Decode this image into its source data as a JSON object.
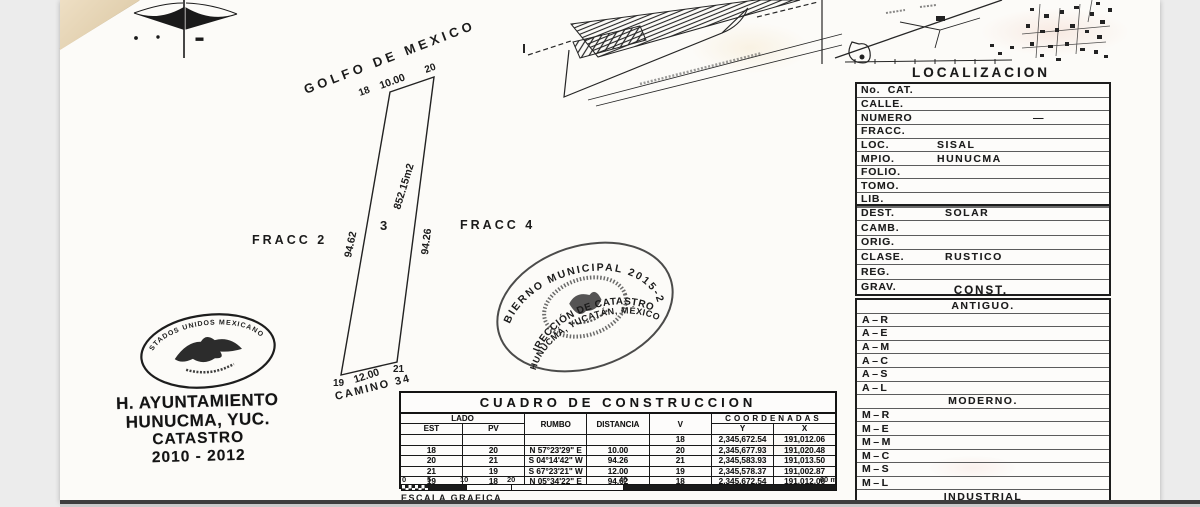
{
  "plot": {
    "golfo_label": "GOLFO DE MEXICO",
    "top": {
      "left_vertex": "18",
      "length": "10.00",
      "right_vertex": "20"
    },
    "bottom": {
      "left_vertex": "19",
      "length": "12.00",
      "right_vertex": "21"
    },
    "left_length": "94.62",
    "right_length": "94.26",
    "area": "852.15m2",
    "lot_number": "3",
    "fracc_left": "FRACC 2",
    "fracc_right": "FRACC 4",
    "camino": "CAMINO 34"
  },
  "round_seal": {
    "ring_top": "GOBIERNO MUNICIPAL 2015-2018",
    "line_mid": "DIRECCIÓN DE CATASTRO",
    "line_bottom": "HUNUCMÁ, YUCATÁN, MÉXICO"
  },
  "eagle_stamp": {
    "ring": "ESTADOS UNIDOS MEXICANOS",
    "line1": "H. AYUNTAMIENTO",
    "line2": "HUNUCMA, YUC.",
    "line3": "CATASTRO",
    "line4": "2010 - 2012"
  },
  "cuadro": {
    "title": "CUADRO DE CONSTRUCCION",
    "headers": {
      "lado": "LADO",
      "est": "EST",
      "pv": "PV",
      "rumbo": "RUMBO",
      "distancia": "DISTANCIA",
      "v": "V",
      "coordenadas": "COORDENADAS",
      "y": "Y",
      "x": "X"
    },
    "rows": [
      {
        "est": "",
        "pv": "",
        "rumbo": "",
        "dist": "",
        "v": "18",
        "y": "2,345,672.54",
        "x": "191,012.06"
      },
      {
        "est": "18",
        "pv": "20",
        "rumbo": "N 57°23'29\" E",
        "dist": "10.00",
        "v": "20",
        "y": "2,345,677.93",
        "x": "191,020.48"
      },
      {
        "est": "20",
        "pv": "21",
        "rumbo": "S 04°14'42\" W",
        "dist": "94.26",
        "v": "21",
        "y": "2,345,583.93",
        "x": "191,013.50"
      },
      {
        "est": "21",
        "pv": "19",
        "rumbo": "S 67°23'21\" W",
        "dist": "12.00",
        "v": "19",
        "y": "2,345,578.37",
        "x": "191,002.87"
      },
      {
        "est": "19",
        "pv": "18",
        "rumbo": "N 05°34'22\" E",
        "dist": "94.62",
        "v": "18",
        "y": "2,345,672.54",
        "x": "191,012.06"
      }
    ]
  },
  "scalebar": {
    "ticks": [
      "0",
      "5",
      "10",
      "20",
      "40"
    ],
    "end": "60 m",
    "label": "ESCALA GRAFICA"
  },
  "panel": {
    "localizacion_title": "LOCALIZACION",
    "localizacion": [
      {
        "label": "No.  CAT.",
        "value": ""
      },
      {
        "label": "CALLE.",
        "value": ""
      },
      {
        "label": "NUMERO",
        "value": "—"
      },
      {
        "label": "FRACC.",
        "value": ""
      },
      {
        "label": "LOC.",
        "value": "SISAL"
      },
      {
        "label": "MPIO.",
        "value": "HUNUCMA"
      },
      {
        "label": "FOLIO.",
        "value": ""
      },
      {
        "label": "TOMO.",
        "value": ""
      },
      {
        "label": "LIB.",
        "value": ""
      }
    ],
    "predio": [
      {
        "label": "DEST.",
        "value": "SOLAR"
      },
      {
        "label": "CAMB.",
        "value": ""
      },
      {
        "label": "ORIG.",
        "value": ""
      },
      {
        "label": "CLASE.",
        "value": "RUSTICO"
      },
      {
        "label": "REG.",
        "value": ""
      },
      {
        "label": "GRAV.",
        "value": ""
      }
    ],
    "const_title": "CONST.",
    "const_groups": [
      {
        "title": "ANTIGUO.",
        "codes": [
          "A–R",
          "A–E",
          "A–M",
          "A–C",
          "A–S",
          "A–L"
        ]
      },
      {
        "title": "MODERNO.",
        "codes": [
          "M–R",
          "M–E",
          "M–M",
          "M–C",
          "M–S",
          "M–L"
        ]
      },
      {
        "title": "INDUSTRIAL",
        "codes": [
          "I–E",
          "I–M"
        ]
      }
    ]
  }
}
